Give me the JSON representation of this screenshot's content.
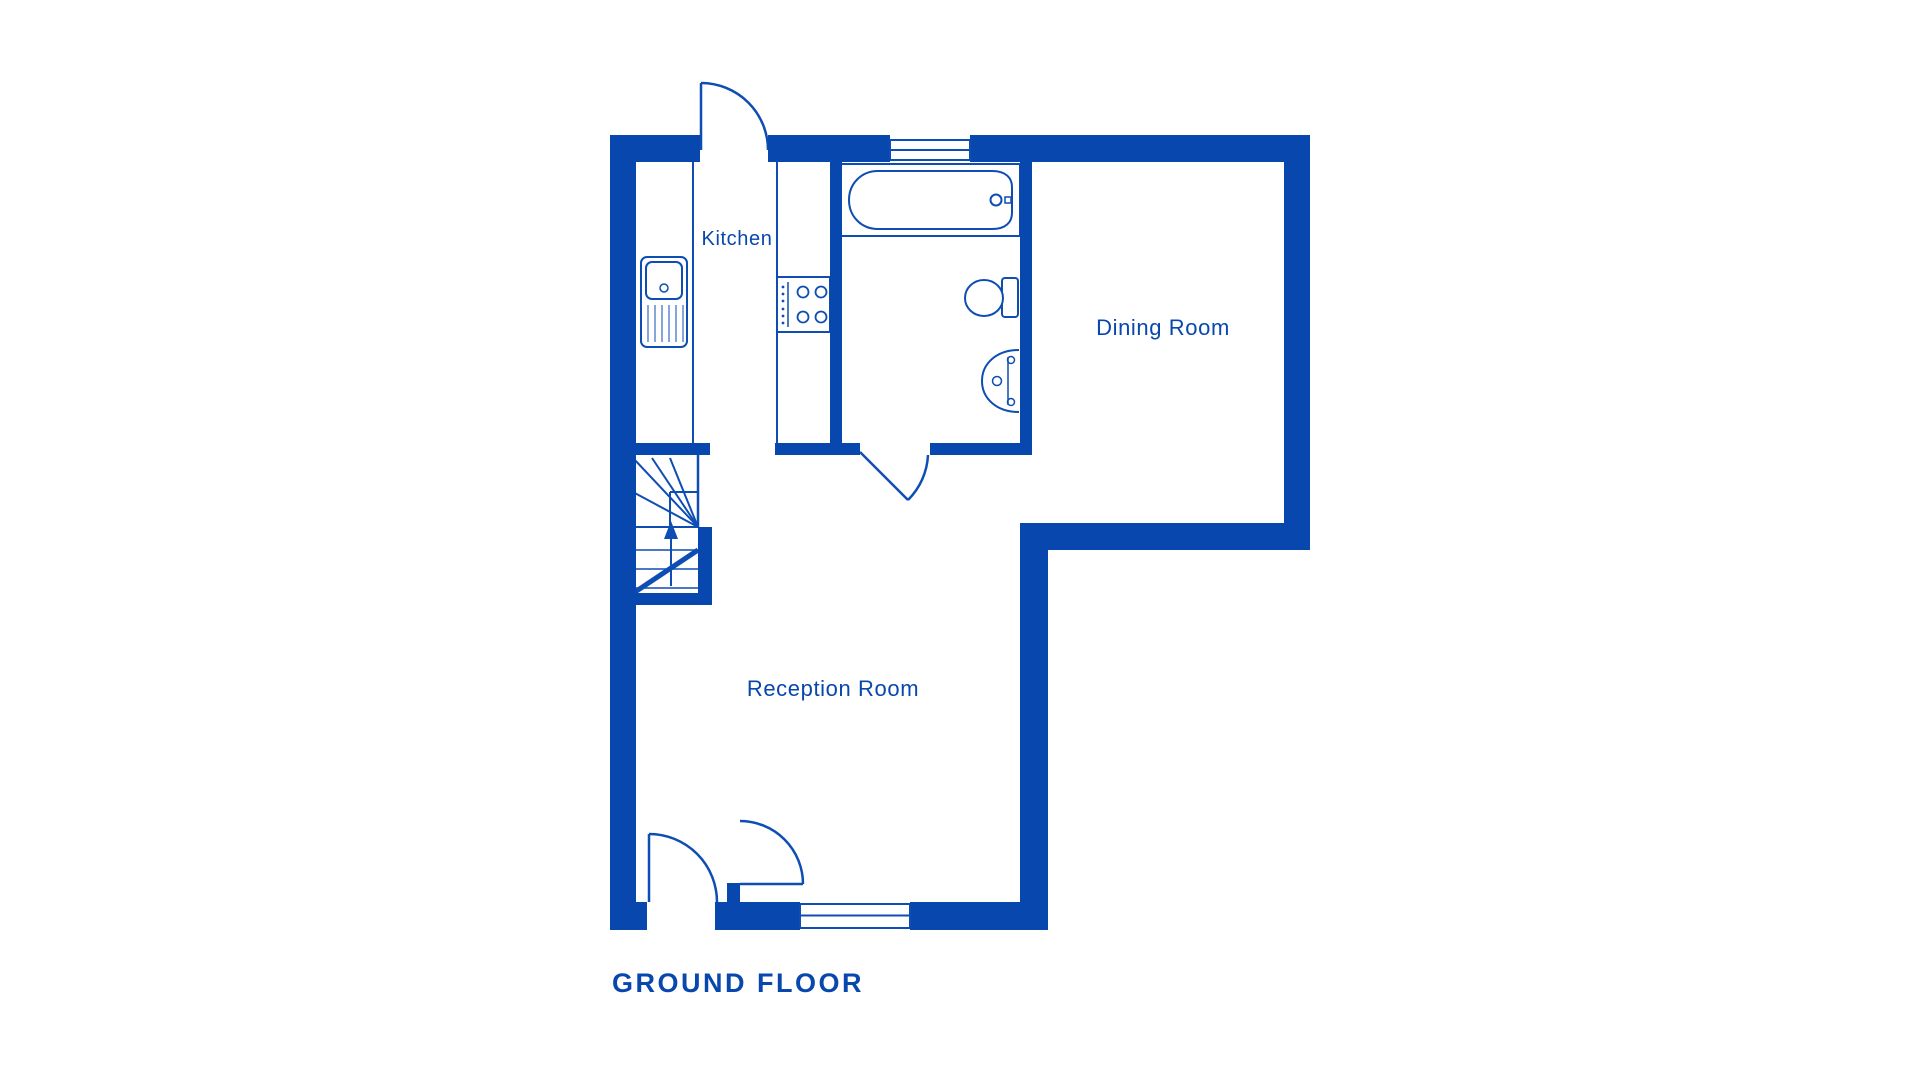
{
  "page": {
    "background": "#ffffff"
  },
  "colors": {
    "accent": "#0847ae",
    "line": "#0e4db4"
  },
  "plan": {
    "title": "GROUND FLOOR",
    "rooms": [
      {
        "id": "kitchen",
        "label": "Kitchen"
      },
      {
        "id": "dining-room",
        "label": "Dining Room"
      },
      {
        "id": "reception-room",
        "label": "Reception Room"
      }
    ],
    "fixtures": [
      "bathtub",
      "toilet",
      "wash-basin",
      "kitchen-sink",
      "hob",
      "staircase-up",
      "kitchen-door",
      "bathroom-door",
      "front-door",
      "hall-door",
      "window-top",
      "window-bottom"
    ]
  }
}
